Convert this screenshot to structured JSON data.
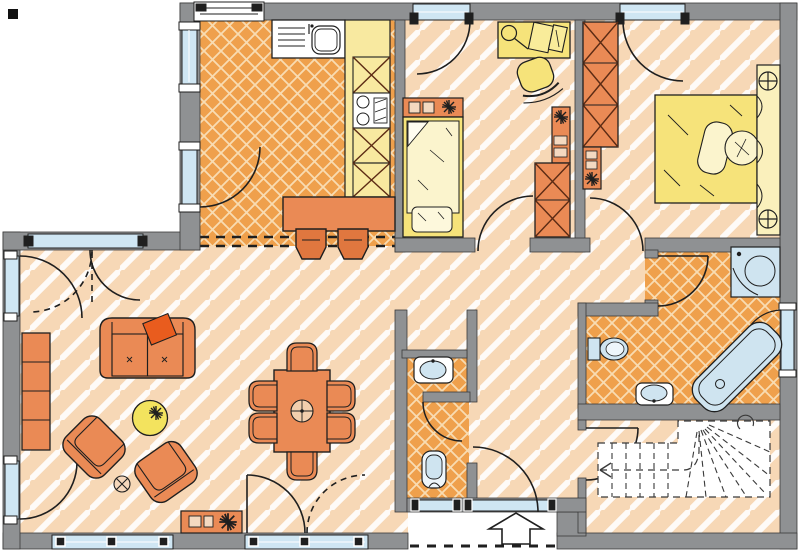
{
  "drawing": {
    "kind": "floor-plan",
    "marker": "black-square-marker"
  },
  "palette": {
    "wall": "#8f9193",
    "outline": "#1f1f1f",
    "stripe_base": "#f7d8b6",
    "stripe_line": "#ffffff",
    "lattice_base": "#efa04c",
    "lattice_line": "#f8dcb2",
    "window_glass": "#cfe6f3",
    "fixture_blue": "#cfe4f0",
    "furniture_orange": "#ea8a55",
    "furniture_dark_orange": "#e0773f",
    "accent_red_orange": "#e95c1e",
    "furniture_yellow": "#f6e37a",
    "pale_yellow": "#faf0bc",
    "counter_yellow": "#f8e9a0",
    "bedding_cream": "#fbf4cd",
    "item_tan": "#f4d9c0",
    "x_brace": "#5c2b14",
    "white": "#ffffff"
  },
  "rooms": [
    {
      "id": "kitchen",
      "floor": "orange-lattice-tile",
      "furniture": [
        "sink-unit",
        "counter",
        "tall-cabinet-x",
        "cooktop",
        "tall-cabinet-x",
        "tall-cabinet-x",
        "breakfast-bar",
        "bar-stool",
        "bar-stool"
      ]
    },
    {
      "id": "child-room",
      "floor": "diagonal-stripe",
      "furniture": [
        "desk",
        "desk-lamp",
        "papers",
        "desk-chair",
        "nightstand",
        "plant",
        "single-bed",
        "pillow",
        "shelf",
        "plant",
        "wardrobe-x"
      ]
    },
    {
      "id": "master-bedroom",
      "floor": "diagonal-stripe",
      "furniture": [
        "wardrobe-x",
        "shelf",
        "plant",
        "double-bed",
        "pillow",
        "pillow",
        "headboard",
        "reading-lamp",
        "reading-lamp"
      ]
    },
    {
      "id": "living-dining",
      "floor": "diagonal-stripe",
      "furniture": [
        "shelf-unit",
        "sofa",
        "cushion",
        "coffee-table",
        "plant",
        "armchair",
        "armchair",
        "flower",
        "dining-table",
        "dining-chair",
        "dining-chair",
        "dining-chair",
        "dining-chair",
        "dining-chair",
        "dining-chair",
        "lowboard",
        "plant"
      ]
    },
    {
      "id": "hall",
      "floor": "diagonal-stripe",
      "furniture": []
    },
    {
      "id": "wc",
      "floor": "orange-lattice-tile",
      "furniture": [
        "washbasin",
        "toilet"
      ]
    },
    {
      "id": "bathroom",
      "floor": "orange-lattice-tile",
      "furniture": [
        "corner-shower",
        "bathtub",
        "toilet",
        "washbasin"
      ]
    },
    {
      "id": "stairs",
      "floor": "diagonal-stripe",
      "furniture": [
        "staircase",
        "walk-line-arrow"
      ]
    }
  ],
  "openings": [
    "entrance-door",
    "terrace-door-living-left-upper",
    "terrace-door-living-left-lower",
    "living-top-double-door",
    "terrace-double-door-bottom",
    "kitchen-side-door",
    "child-room-door",
    "bedroom-door",
    "bathroom-door",
    "stairs-door",
    "wc-door"
  ],
  "entrance": {
    "symbol": "arrow-into-house",
    "canopy": "dashed-line"
  }
}
